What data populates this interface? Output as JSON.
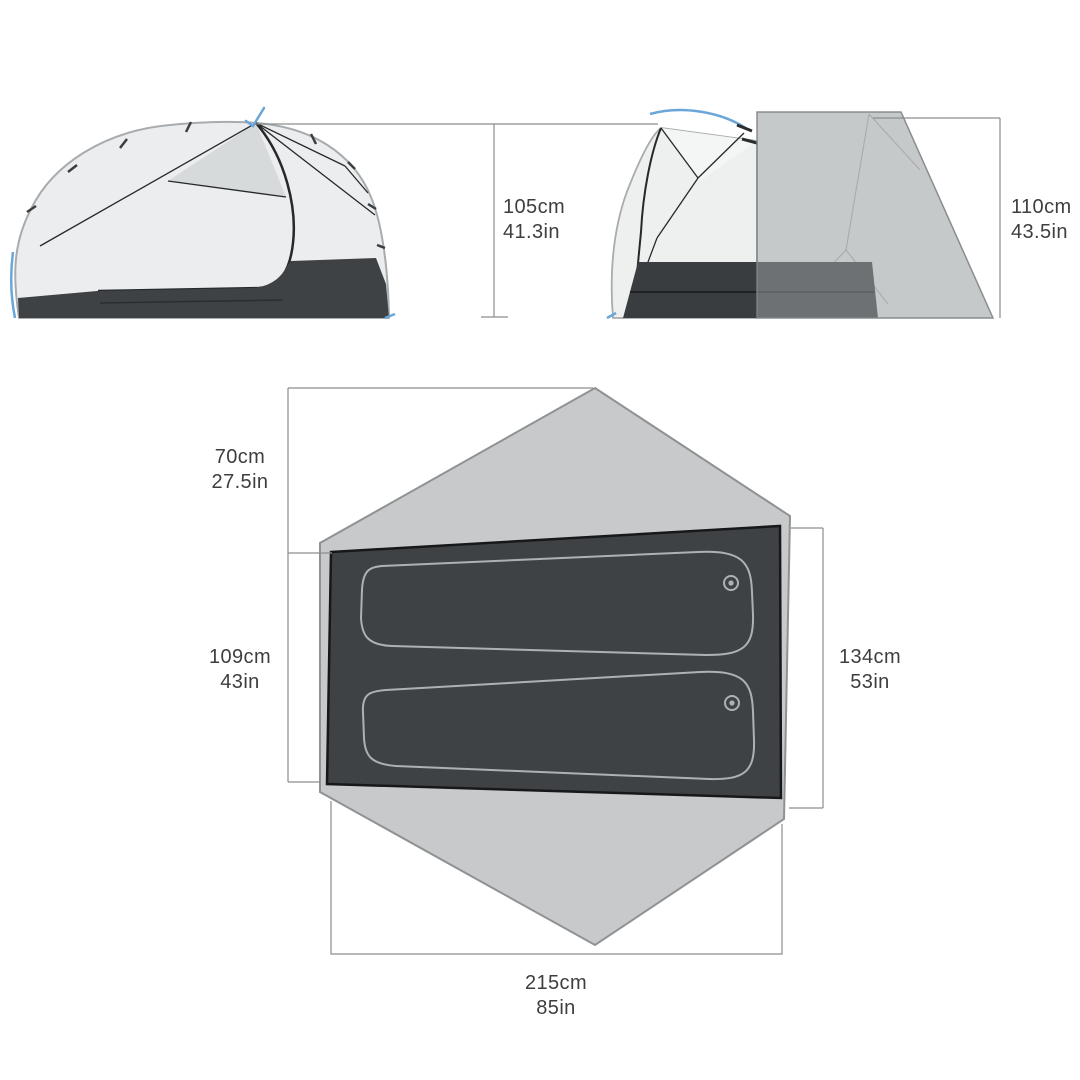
{
  "diagram": {
    "kind": "tent-dimensions-spec",
    "views": {
      "side_view": "inner tent side profile",
      "front_view": "tent front with fly",
      "floor_plan": "fly footprint with floor and two sleeping pads"
    }
  },
  "measurements": {
    "side_height": {
      "cm": "105cm",
      "in": "41.3in"
    },
    "fly_height": {
      "cm": "110cm",
      "in": "43.5in"
    },
    "vestibule_depth": {
      "cm": "70cm",
      "in": "27.5in"
    },
    "floor_width_left": {
      "cm": "109cm",
      "in": "43in"
    },
    "floor_width_right": {
      "cm": "134cm",
      "in": "53in"
    },
    "floor_length": {
      "cm": "215cm",
      "in": "85in"
    }
  },
  "colors": {
    "background": "#ffffff",
    "dimension_line": "#8d8d8d",
    "label_text": "#3e3e3e",
    "fabric_light": "#ebedee",
    "mesh_panel": "#d6dadb",
    "floor_dark": "#3f4245",
    "pole_gray": "#a8acae",
    "seam_black": "#26282a",
    "fly_gray": "#c7c9ca",
    "footprint_gray": "#c7c9ca",
    "pad_outline": "#aeb1b3",
    "accent_blue": "#6ba6d9"
  }
}
